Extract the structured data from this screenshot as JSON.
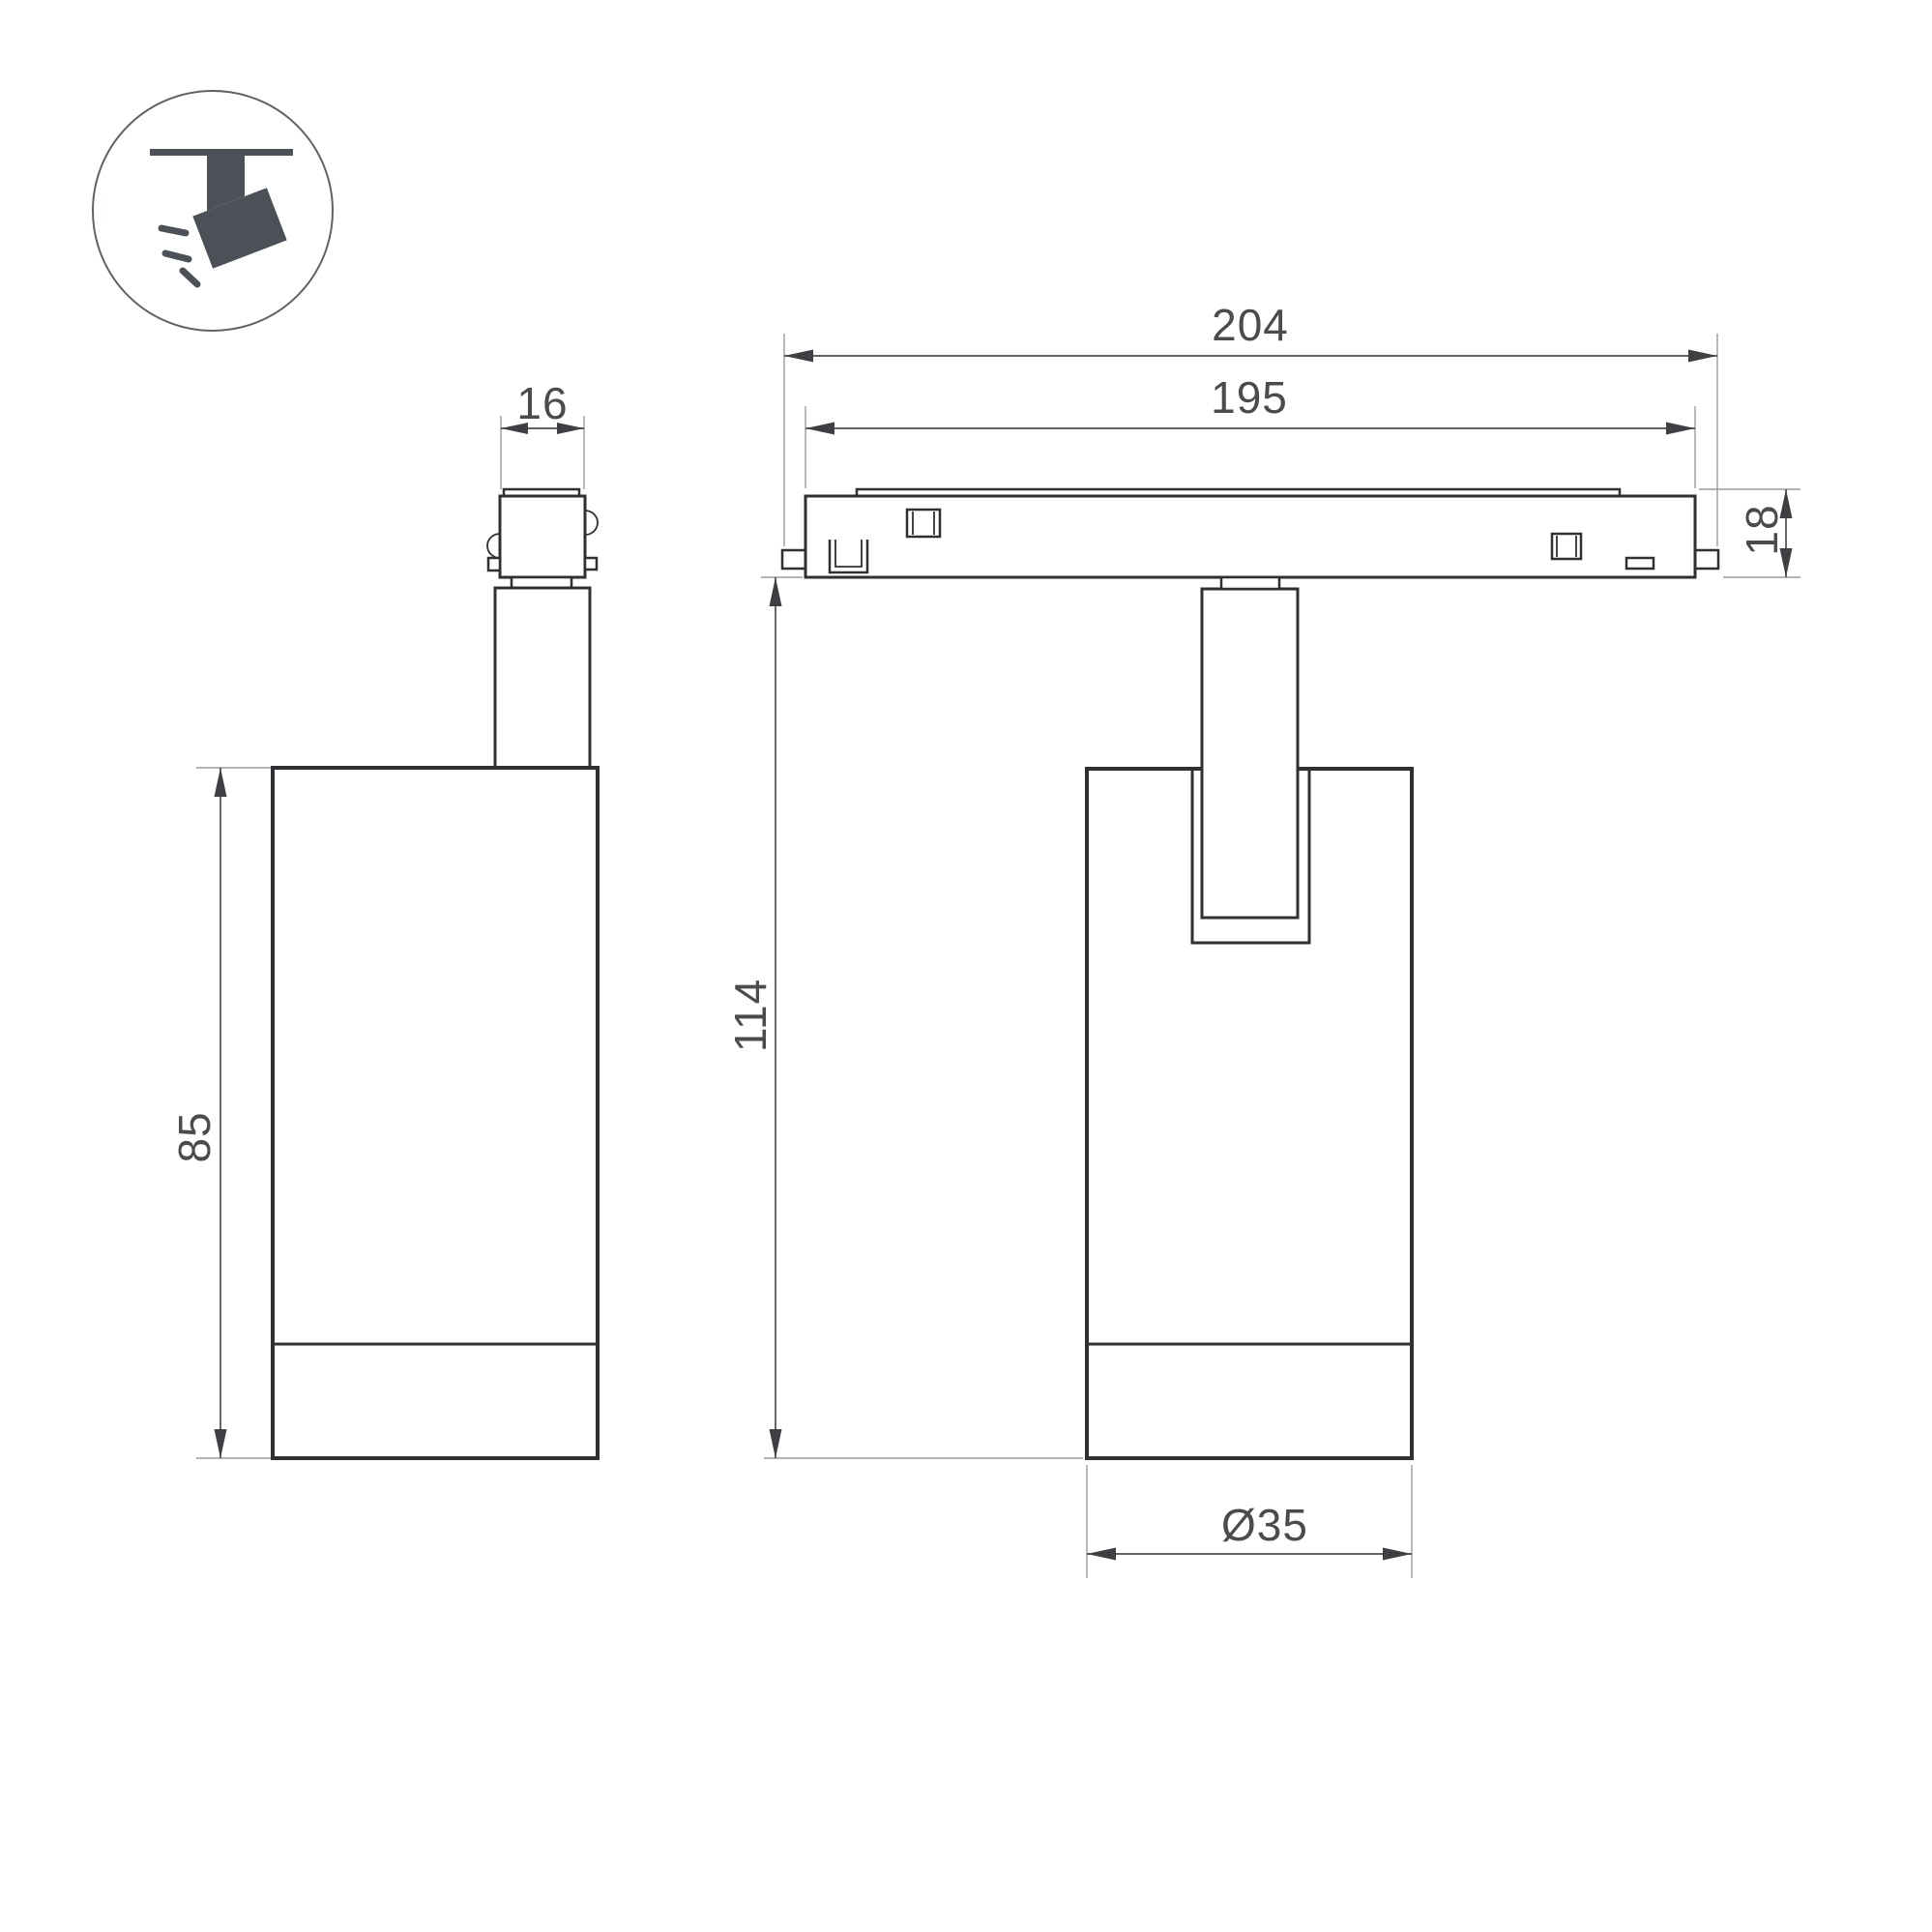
{
  "icon": {
    "name": "ceiling-track-spotlight-icon"
  },
  "dimensions": {
    "adapter_width": "16",
    "track_overall_length": "204",
    "track_length": "195",
    "track_height": "18",
    "lamp_body_height": "85",
    "overall_drop_height": "114",
    "lamp_body_diameter": "Ø35"
  },
  "colors": {
    "background": "#ffffff",
    "outline": "#2f3033",
    "dimension_line": "#4d4e50",
    "extension_line": "#9b9b9b",
    "arrow": "#3e3f42",
    "dimension_text": "#4a4b4d",
    "icon_fill": "#4b5157",
    "icon_circle_stroke": "#5f6367"
  }
}
